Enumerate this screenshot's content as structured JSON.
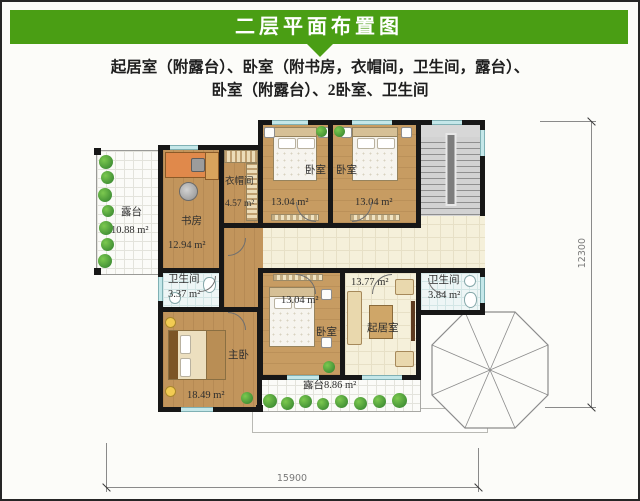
{
  "header": {
    "title": "二层平面布置图"
  },
  "subtitle": {
    "line1": "起居室（附露台）、卧室（附书房，衣帽间，卫生间，露台）、",
    "line2": "卧室（附露台）、2卧室、卫生间"
  },
  "rooms": {
    "terrace_left": {
      "name": "露台",
      "area": "10.88 m²"
    },
    "study": {
      "name": "书房",
      "area": "12.94 m²"
    },
    "cloakroom": {
      "name": "衣帽间",
      "area": "4.57 m²"
    },
    "bedroom_top_left": {
      "name": "卧室",
      "area": "13.04 m²"
    },
    "bedroom_top_right": {
      "name": "卧室",
      "area": "13.04 m²"
    },
    "bathroom_left": {
      "name": "卫生间",
      "area": "3.37 m²"
    },
    "master_bedroom": {
      "name": "主卧",
      "area": "18.49 m²"
    },
    "bedroom_bottom": {
      "name": "卧室",
      "area": "13.04 m²"
    },
    "living_room": {
      "name": "起居室",
      "area": "13.77 m²"
    },
    "bathroom_right": {
      "name": "卫生间",
      "area": "3.84 m²"
    },
    "terrace_bottom": {
      "name": "露台",
      "area": "8.86 m²"
    }
  },
  "dimensions": {
    "width": "15900",
    "height": "12300"
  },
  "colors": {
    "header_green": "#4a9e14",
    "wall_black": "#171717",
    "wood_floor": "#c79c62",
    "hall_cream": "#f5f0da",
    "window_cyan": "#c4e7e9",
    "stair_gray": "#d2d2d2",
    "plant_green": "#2e7d2c"
  }
}
